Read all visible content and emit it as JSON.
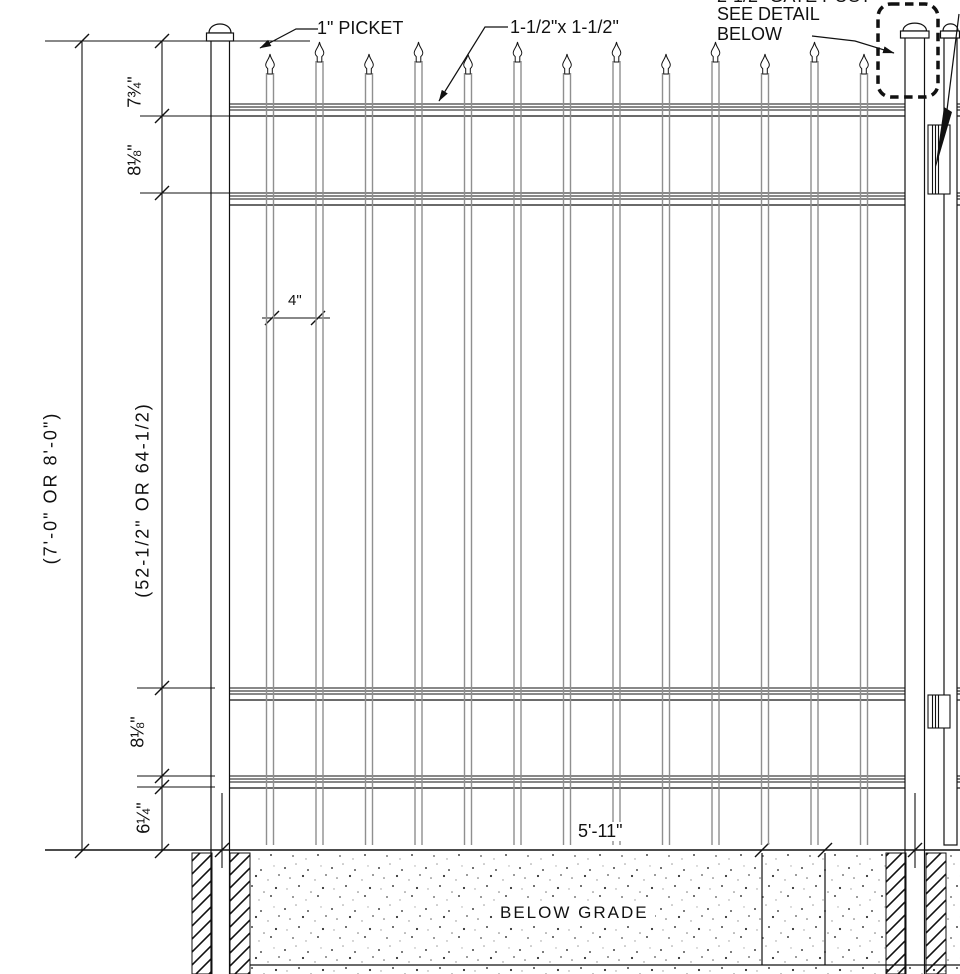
{
  "labels": {
    "picket": "1\" PICKET",
    "rail_size": "1-1/2\"x 1-1/2\"",
    "gate_post_clipped": "2-1/2\" GATE POST",
    "see_detail_line1": "SEE DETAIL",
    "see_detail_line2": "BELOW",
    "below_grade": "BELOW GRADE"
  },
  "dimensions": {
    "overall_height": "(7'-0\" OR 8'-0\")",
    "picket_area_height": "(52-1/2\" OR 64-1/2)",
    "top_rail_offset": "7¾\"",
    "rail_spacing_top": "8⅛\"",
    "rail_spacing_bottom": "8⅛\"",
    "bottom_rail_to_grade": "6¼\"",
    "picket_gap": "4\"",
    "panel_width": "5'-11\""
  },
  "colors": {
    "line": "#111111",
    "picket_line": "#8f8f8f"
  }
}
